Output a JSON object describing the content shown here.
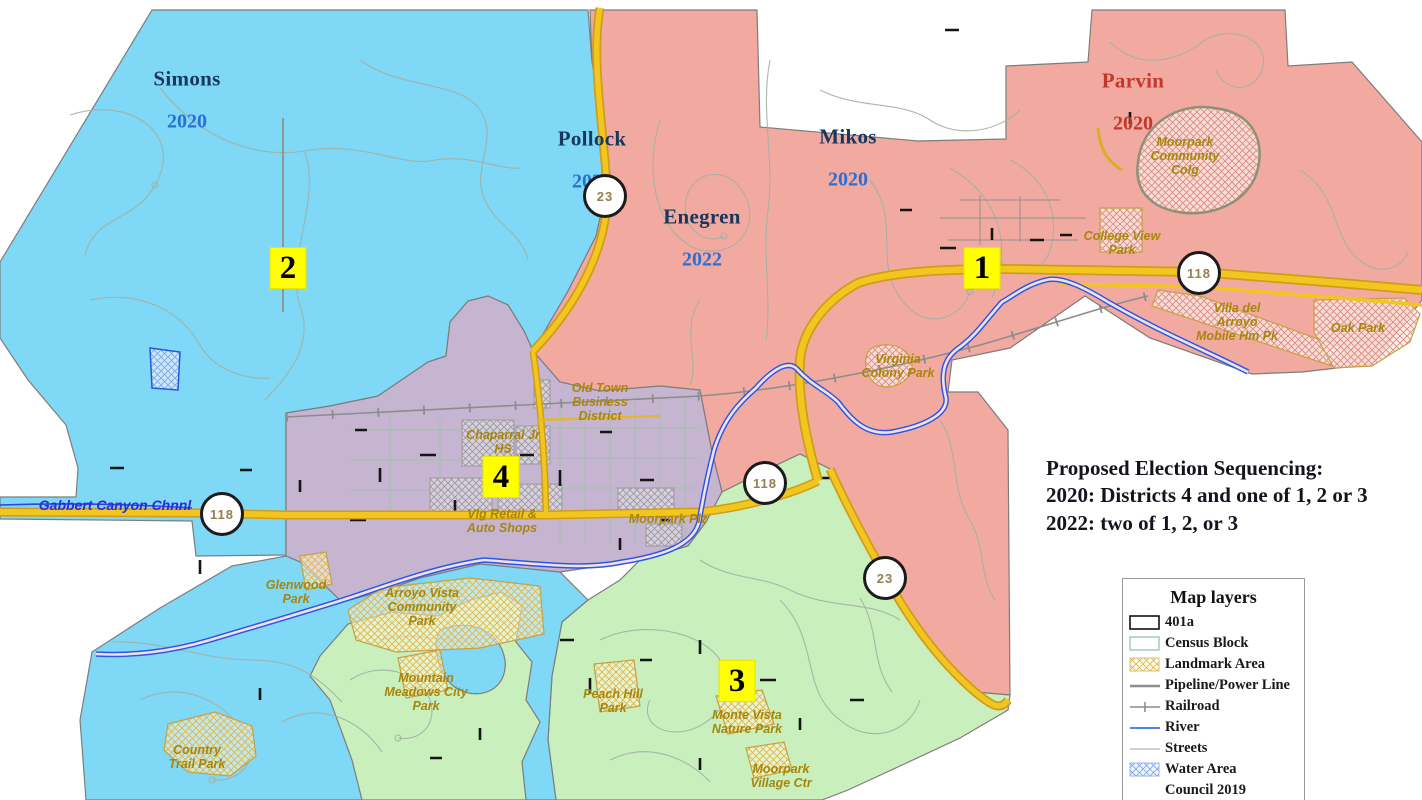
{
  "annotation": {
    "line1": "Proposed Election Sequencing:",
    "line2": "2020: Districts 4 and one of 1, 2 or 3",
    "line3": "2022: two of 1, 2, or 3"
  },
  "council_labels": [
    {
      "name": "Simons",
      "year": "2020",
      "color": "blue"
    },
    {
      "name": "Pollock",
      "year": "2022",
      "color": "blue"
    },
    {
      "name": "Mikos",
      "year": "2020",
      "color": "blue"
    },
    {
      "name": "Enegren",
      "year": "2022",
      "color": "blue"
    },
    {
      "name": "Parvin",
      "year": "2020",
      "color": "red"
    }
  ],
  "district_badges": [
    {
      "number": "1"
    },
    {
      "number": "2"
    },
    {
      "number": "3"
    },
    {
      "number": "4"
    }
  ],
  "route_shields": [
    {
      "number": "23"
    },
    {
      "number": "118"
    },
    {
      "number": "118"
    },
    {
      "number": "118"
    },
    {
      "number": "23"
    }
  ],
  "places": [
    {
      "id": "moorpark-community-college",
      "text": "Moorpark\nCommunity\nColg"
    },
    {
      "id": "college-view-park",
      "text": "College View\nPark"
    },
    {
      "id": "villa-del-arroyo",
      "text": "Villa del\nArroyo\nMobile Hm Pk"
    },
    {
      "id": "oak-park",
      "text": "Oak Park"
    },
    {
      "id": "virginia-colony-park",
      "text": "Virginia\nColony Park"
    },
    {
      "id": "old-town-business-district",
      "text": "Old Town\nBusiness\nDistrict"
    },
    {
      "id": "chaparral-jr-hs",
      "text": "Chaparral Jr\nHS"
    },
    {
      "id": "vlg-retail-auto-shops",
      "text": "Vlg Retail &\nAuto Shops"
    },
    {
      "id": "moorpark-plz",
      "text": "Moorpark Plz"
    },
    {
      "id": "glenwood-park",
      "text": "Glenwood\nPark"
    },
    {
      "id": "arroyo-vista-community-park",
      "text": "Arroyo Vista\nCommunity\nPark"
    },
    {
      "id": "mountain-meadows-city-park",
      "text": "Mountain\nMeadows City\nPark"
    },
    {
      "id": "peach-hill-park",
      "text": "Peach Hill\nPark"
    },
    {
      "id": "monte-vista-nature-park",
      "text": "Monte Vista\nNature Park"
    },
    {
      "id": "moorpark-village-ctr",
      "text": "Moorpark\nVillage Ctr"
    },
    {
      "id": "country-trail-park",
      "text": "Country\nTrail Park"
    }
  ],
  "water_label": "Gabbert Canyon Chnnl",
  "legend": {
    "title": "Map layers",
    "items": [
      {
        "label": "401a",
        "symbol": "black-outline-box"
      },
      {
        "label": "Census Block",
        "symbol": "green-outline-box"
      },
      {
        "label": "Landmark Area",
        "symbol": "tan-hatch-box"
      },
      {
        "label": "Pipeline/Power Line",
        "symbol": "gray-line"
      },
      {
        "label": "Railroad",
        "symbol": "railroad-line"
      },
      {
        "label": "River",
        "symbol": "blue-line"
      },
      {
        "label": "Streets",
        "symbol": "light-gray-line"
      },
      {
        "label": "Water Area",
        "symbol": "blue-hatch-box"
      },
      {
        "label": "Council 2019",
        "symbol": "none"
      }
    ]
  },
  "colors": {
    "district_1_pink": "#f2aaa0",
    "district_2_blue": "#7fd8f5",
    "district_3_green": "#c9efbd",
    "district_4_purple": "#c6b5d1",
    "road_yellow": "#f2c61e",
    "river_blue": "#2e55e8",
    "badge_yellow": "#ffff00",
    "park_label_gold": "#a8860b"
  }
}
